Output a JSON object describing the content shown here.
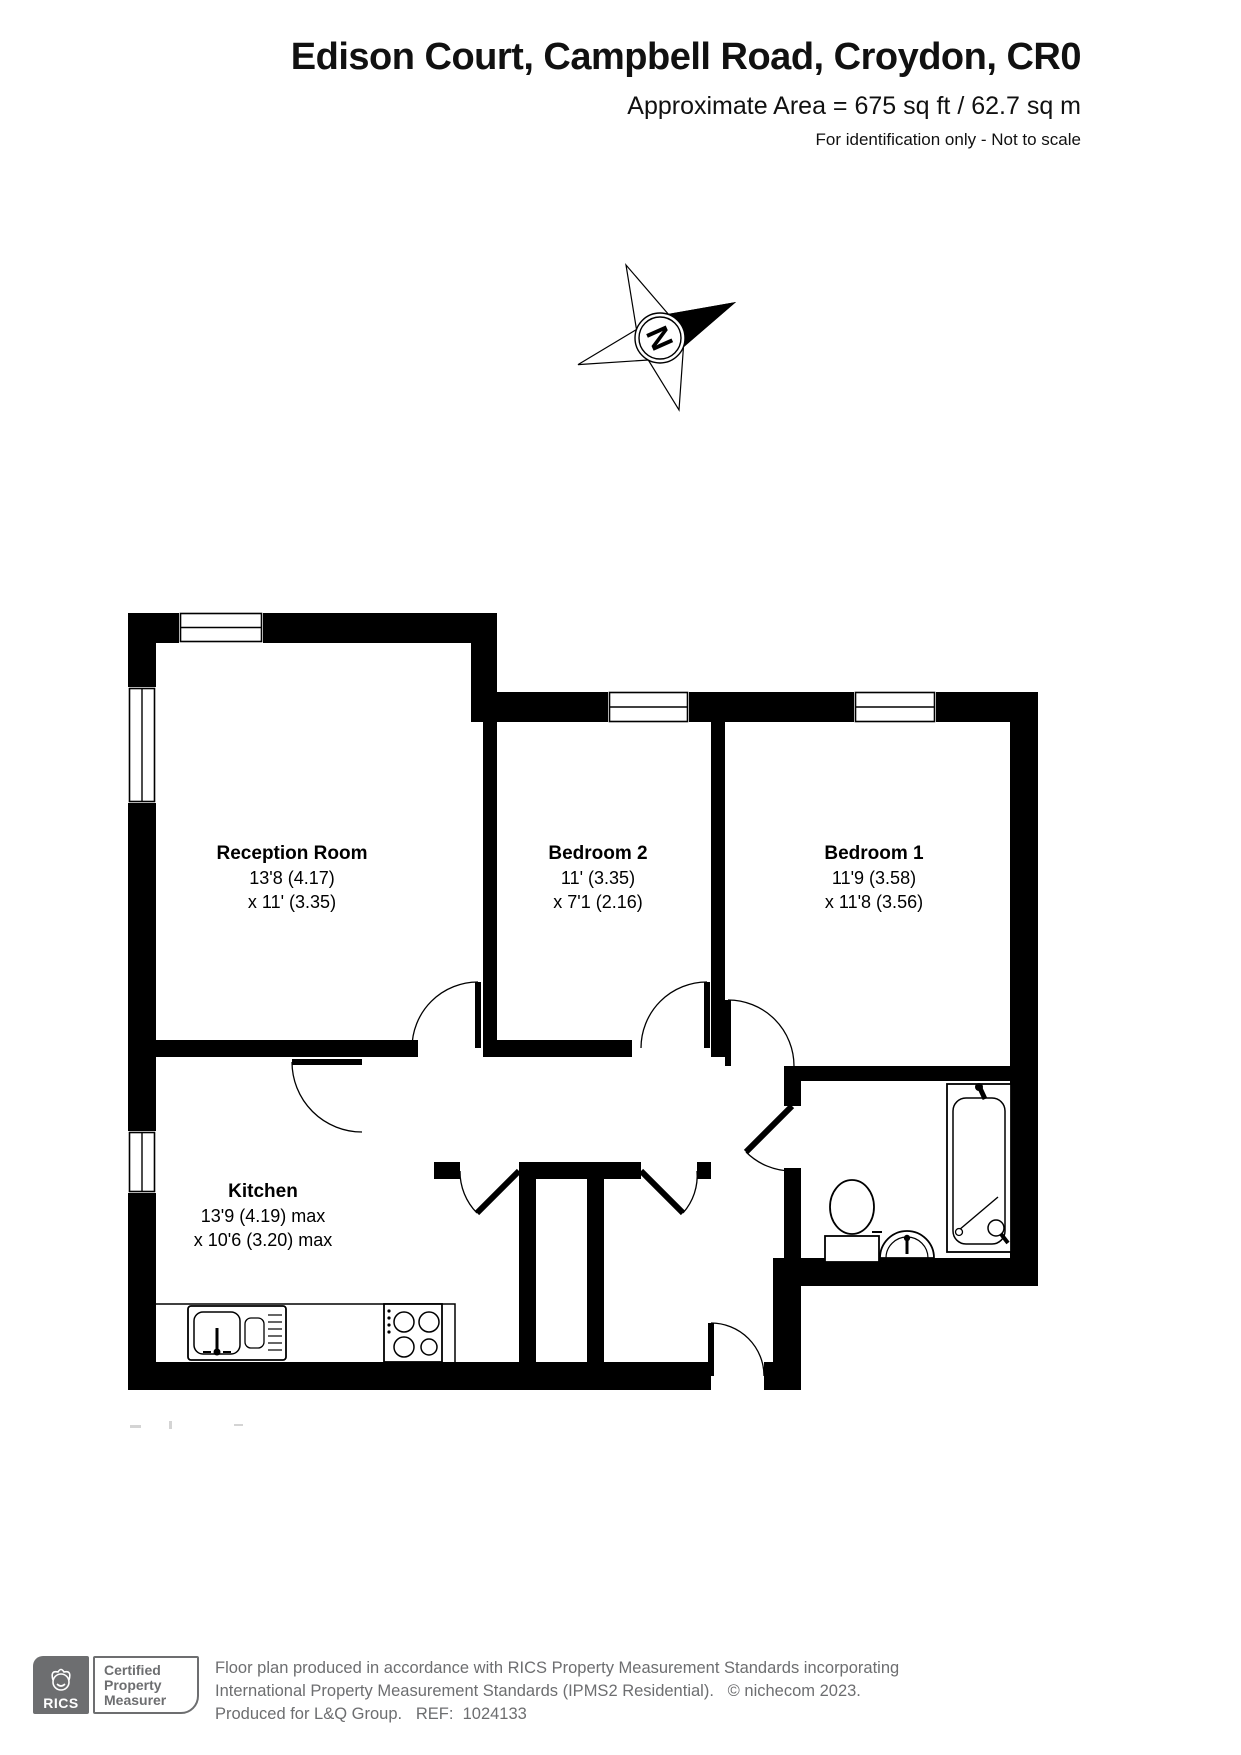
{
  "header": {
    "title": "Edison Court, Campbell Road, Croydon, CR0",
    "area_line": "Approximate Area = 675 sq ft / 62.7 sq m",
    "note": "For identification only - Not to scale"
  },
  "compass": {
    "label": "N"
  },
  "rooms": {
    "reception": {
      "name": "Reception Room",
      "dim1": "13'8 (4.17)",
      "dim2": "x 11' (3.35)"
    },
    "bedroom2": {
      "name": "Bedroom 2",
      "dim1": "11' (3.35)",
      "dim2": "x 7'1 (2.16)"
    },
    "bedroom1": {
      "name": "Bedroom 1",
      "dim1": "11'9 (3.58)",
      "dim2": "x 11'8 (3.56)"
    },
    "kitchen": {
      "name": "Kitchen",
      "dim1": "13'9 (4.19) max",
      "dim2": "x 10'6 (3.20) max"
    }
  },
  "footer": {
    "rics_label": "RICS",
    "badge_lines": [
      "Certified",
      "Property",
      "Measurer"
    ],
    "line1": "Floor plan produced in accordance with RICS Property Measurement Standards incorporating",
    "line2": "International Property Measurement Standards (IPMS2 Residential).   © nichecom 2023.",
    "line3": "Produced for L&Q Group.   REF:  1024133"
  },
  "colors": {
    "wall": "#000000",
    "footer_gray": "#6d6e70"
  }
}
